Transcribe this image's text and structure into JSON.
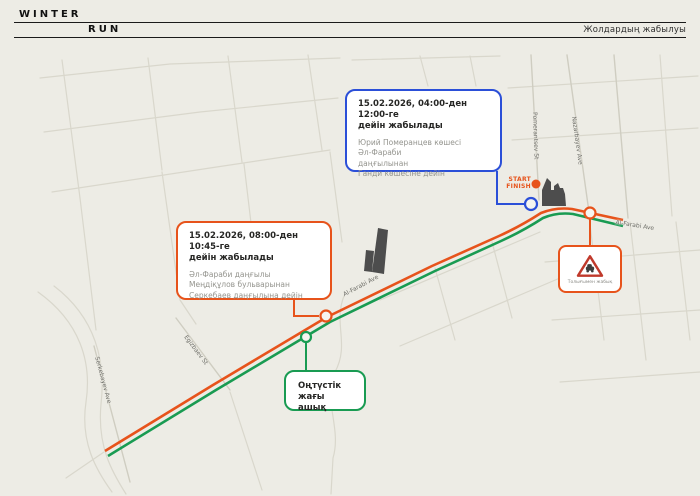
{
  "header": {
    "logo_top": "WINTER",
    "logo_bottom": "RUN",
    "page_label": "Жолдардың жабылуы"
  },
  "colors": {
    "background": "#edece5",
    "accent_orange": "#e7531b",
    "accent_green": "#199b52",
    "accent_blue": "#2b4fd8",
    "ink": "#1a1a1a"
  },
  "callouts": {
    "blue_closure": {
      "title": "15.02.2026, 04:00-ден 12:00-ге\nдейін жабылады",
      "body": "Юрий Померанцев көшесі\nӘл-Фараби\nдаңғылынан\nГанди көшесіне дейін"
    },
    "orange_closure": {
      "title": "15.02.2026, 08:00-ден 10:45-ге\nдейін жабылады",
      "body": "Әл-Фараби даңғылы\nМеңдіқұлов бульварынан\nСеркебаев даңғылына дейін"
    },
    "south_side_open": {
      "text": "Оңтүстік жағы\nашық"
    },
    "fully_closed_sign": {
      "caption": "Толығымен жабық"
    }
  },
  "markers": {
    "start_finish": "START\nFINISH"
  },
  "street_labels": [
    {
      "text": "Al-Farabi Ave"
    },
    {
      "text": "Al-Farabi Ave"
    },
    {
      "text": "Pomerantsev St"
    },
    {
      "text": "Nazarbayev Ave"
    },
    {
      "text": "Serkebayev Ave"
    },
    {
      "text": "Egizbaev St"
    }
  ]
}
